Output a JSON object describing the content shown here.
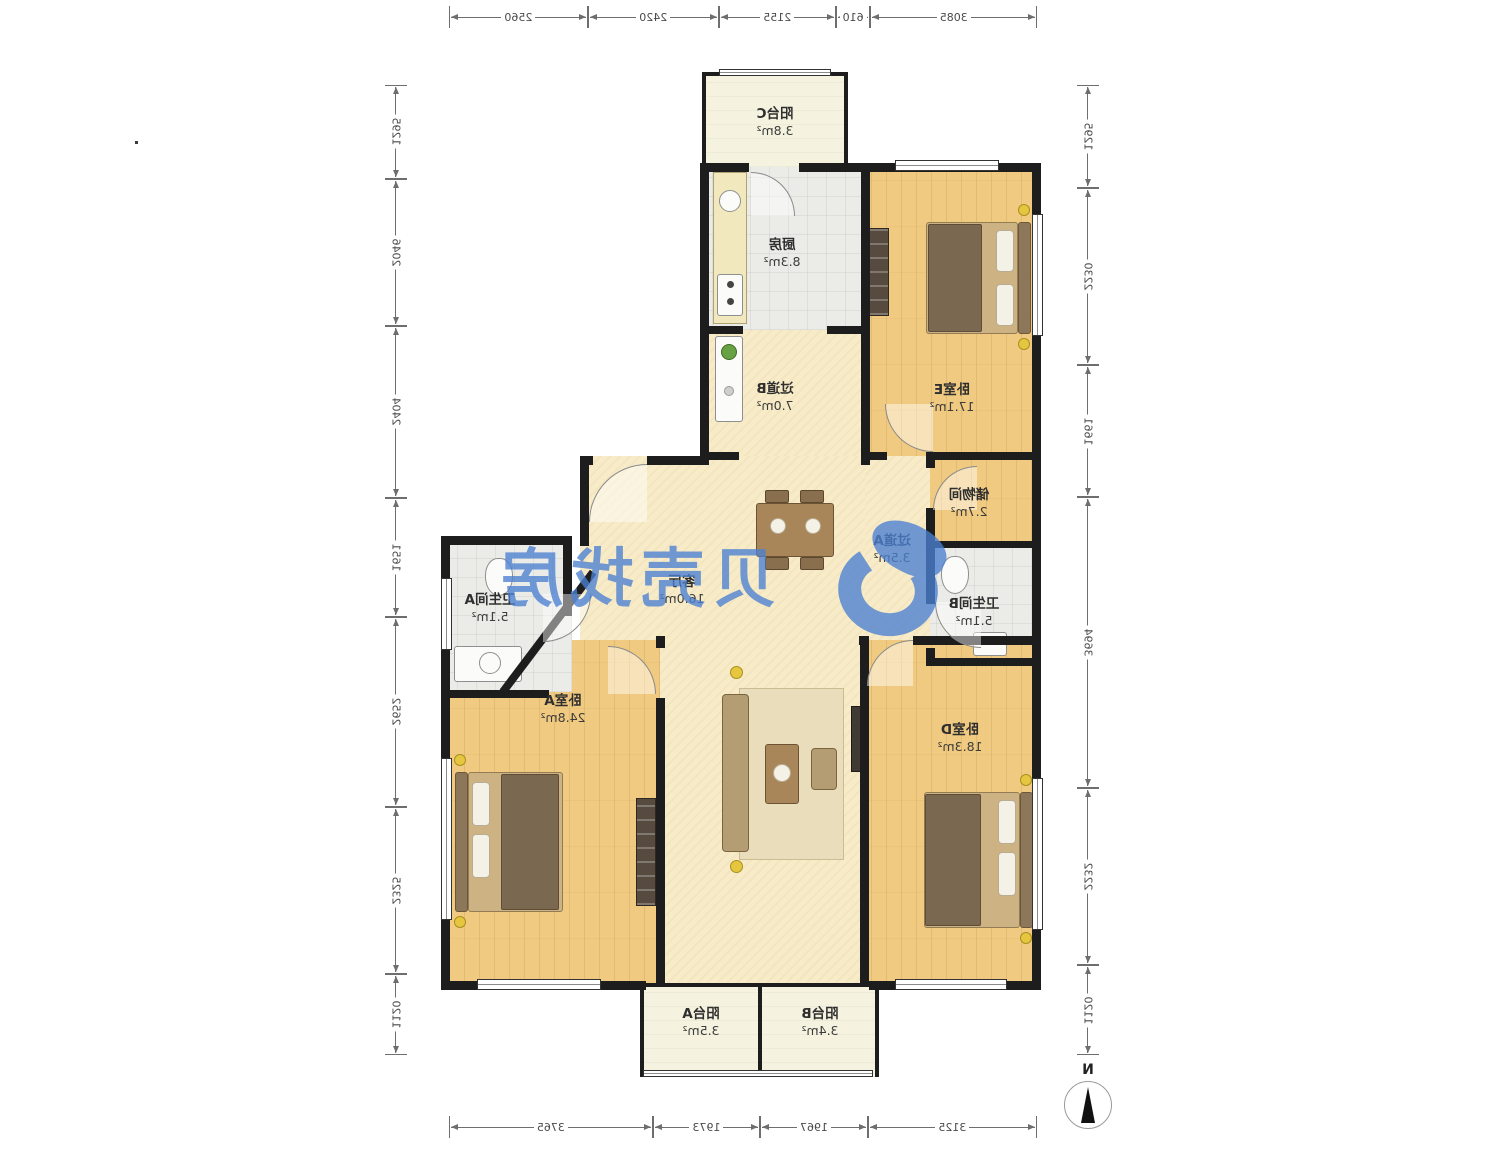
{
  "rooms": {
    "balcony_c": {
      "name": "阳台C",
      "area": "3.8m²"
    },
    "kitchen": {
      "name": "厨房",
      "area": "8.3m²"
    },
    "bedroom_e": {
      "name": "卧室E",
      "area": "17.1m²"
    },
    "hallway_b": {
      "name": "过道B",
      "area": "7.0m²"
    },
    "storage": {
      "name": "储物间",
      "area": "2.7m²"
    },
    "bath_b": {
      "name": "卫生间B",
      "area": "5.1m²"
    },
    "hallway_a": {
      "name": "过道A",
      "area": "3.5m²"
    },
    "living": {
      "name": "客厅",
      "area": "16.0m²"
    },
    "bath_a": {
      "name": "卫生间A",
      "area": "5.1m²"
    },
    "bedroom_a": {
      "name": "卧室A",
      "area": "24.8m²"
    },
    "bedroom_d": {
      "name": "卧室D",
      "area": "18.3m²"
    },
    "balcony_a": {
      "name": "阳台A",
      "area": "3.5m²"
    },
    "balcony_b": {
      "name": "阳台B",
      "area": "3.4m²"
    }
  },
  "dimensions": {
    "top": [
      3085,
      610,
      2155,
      2420,
      2560
    ],
    "bottom": [
      3125,
      1967,
      1973,
      3765
    ],
    "left": [
      1295,
      2230,
      1661,
      3694,
      2232,
      1120
    ],
    "right": [
      1295,
      2046,
      2404,
      1651,
      2652,
      2325,
      1120
    ]
  },
  "compass": {
    "north_label": "N"
  },
  "watermark": {
    "text": "贝壳找房",
    "color": "#4b80d2"
  },
  "colors": {
    "wall": "#1d1d1d",
    "wood_floor": "#f0ca80",
    "living_floor": "#f7ebc8",
    "tile_floor": "#ebebe8",
    "balcony_floor": "#f5f3df",
    "dimension_text": "#4a4a4a",
    "watermark_blue": "#4b80d2"
  }
}
